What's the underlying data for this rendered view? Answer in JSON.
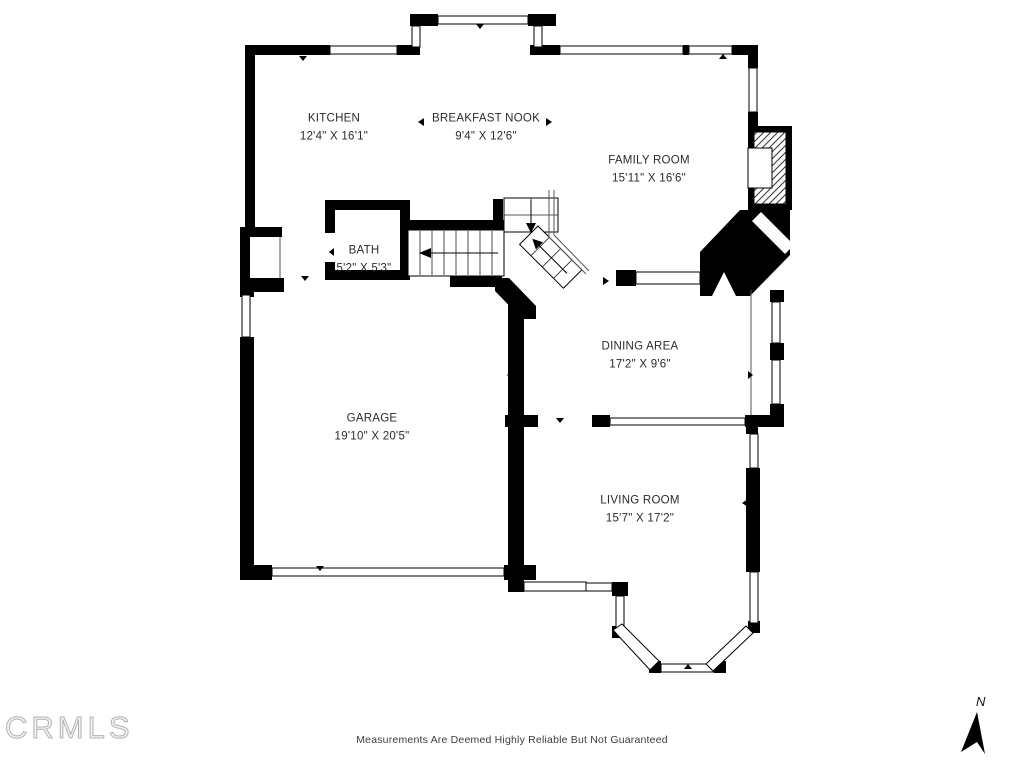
{
  "page": {
    "watermark": "CRMLS",
    "disclaimer": "Measurements Are Deemed Highly Reliable But Not Guaranteed",
    "compass_label": "N"
  },
  "rooms": [
    {
      "name": "KITCHEN",
      "dims": "12'4\" X 16'1\""
    },
    {
      "name": "BREAKFAST NOOK",
      "dims": "9'4\" X 12'6\""
    },
    {
      "name": "FAMILY ROOM",
      "dims": "15'11\" X 16'6\""
    },
    {
      "name": "BATH",
      "dims": "5'2\" X 5'3\""
    },
    {
      "name": "DINING AREA",
      "dims": "17'2\" X 9'6\""
    },
    {
      "name": "GARAGE",
      "dims": "19'10\" X 20'5\""
    },
    {
      "name": "LIVING ROOM",
      "dims": "15'7\" X 17'2\""
    }
  ],
  "colors": {
    "wall": "#000000",
    "label_text": "#2b2b2b",
    "watermark": "#b3b3b3",
    "disclaimer_text": "#3d3d3d"
  }
}
